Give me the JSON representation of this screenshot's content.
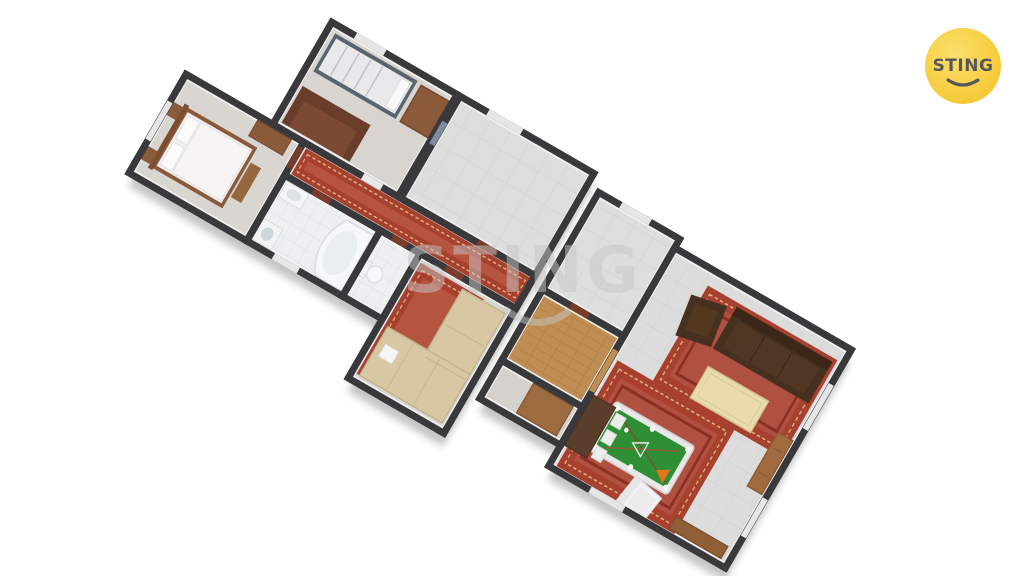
{
  "scene": {
    "type": "3d-apartment-floor-plan-render",
    "background_color": "#ffffff",
    "view": "aerial axonometric, plan rotated about 30 degrees"
  },
  "branding": {
    "logo_text": "STING",
    "logo_bg_color": "#f6cd3d",
    "logo_text_color": "#55575c"
  },
  "watermark": {
    "text": "STING",
    "color": "#c7c7c7"
  },
  "floor_plan": {
    "wall_color": "#39393b",
    "floor_color": "#dcdcdc",
    "bath_tile_color": "#eef0f1",
    "wood_floor_color": "#c08d53",
    "carpet_color": "#a8402f",
    "pool_table_felt_color": "#2f8f35",
    "rooms": [
      {
        "name": "children-bedroom",
        "furniture": [
          "bunk-bed",
          "brown-sofa",
          "cabinet"
        ]
      },
      {
        "name": "bedroom",
        "furniture": [
          "double-bed",
          "nightstands",
          "dresser",
          "bench"
        ]
      },
      {
        "name": "empty-room-top",
        "furniture": []
      },
      {
        "name": "hallway",
        "furniture": [
          "red-runner-rug"
        ]
      },
      {
        "name": "bathroom",
        "furniture": [
          "corner-bathtub",
          "sink",
          "washing-machine"
        ]
      },
      {
        "name": "wc",
        "furniture": [
          "toilet"
        ]
      },
      {
        "name": "lounge",
        "furniture": [
          "beige-corner-sofa",
          "red-rug"
        ]
      },
      {
        "name": "empty-room-right",
        "furniture": []
      },
      {
        "name": "corridor",
        "furniture": [
          "wardrobe"
        ]
      },
      {
        "name": "living-room",
        "furniture": [
          "dark-sofa",
          "dark-armchair",
          "coffee-table",
          "oriental-rug-1",
          "oriental-rug-2",
          "pool-table",
          "dining-table",
          "chairs",
          "sideboard",
          "wall-cabinet",
          "white-armchair"
        ]
      }
    ]
  }
}
